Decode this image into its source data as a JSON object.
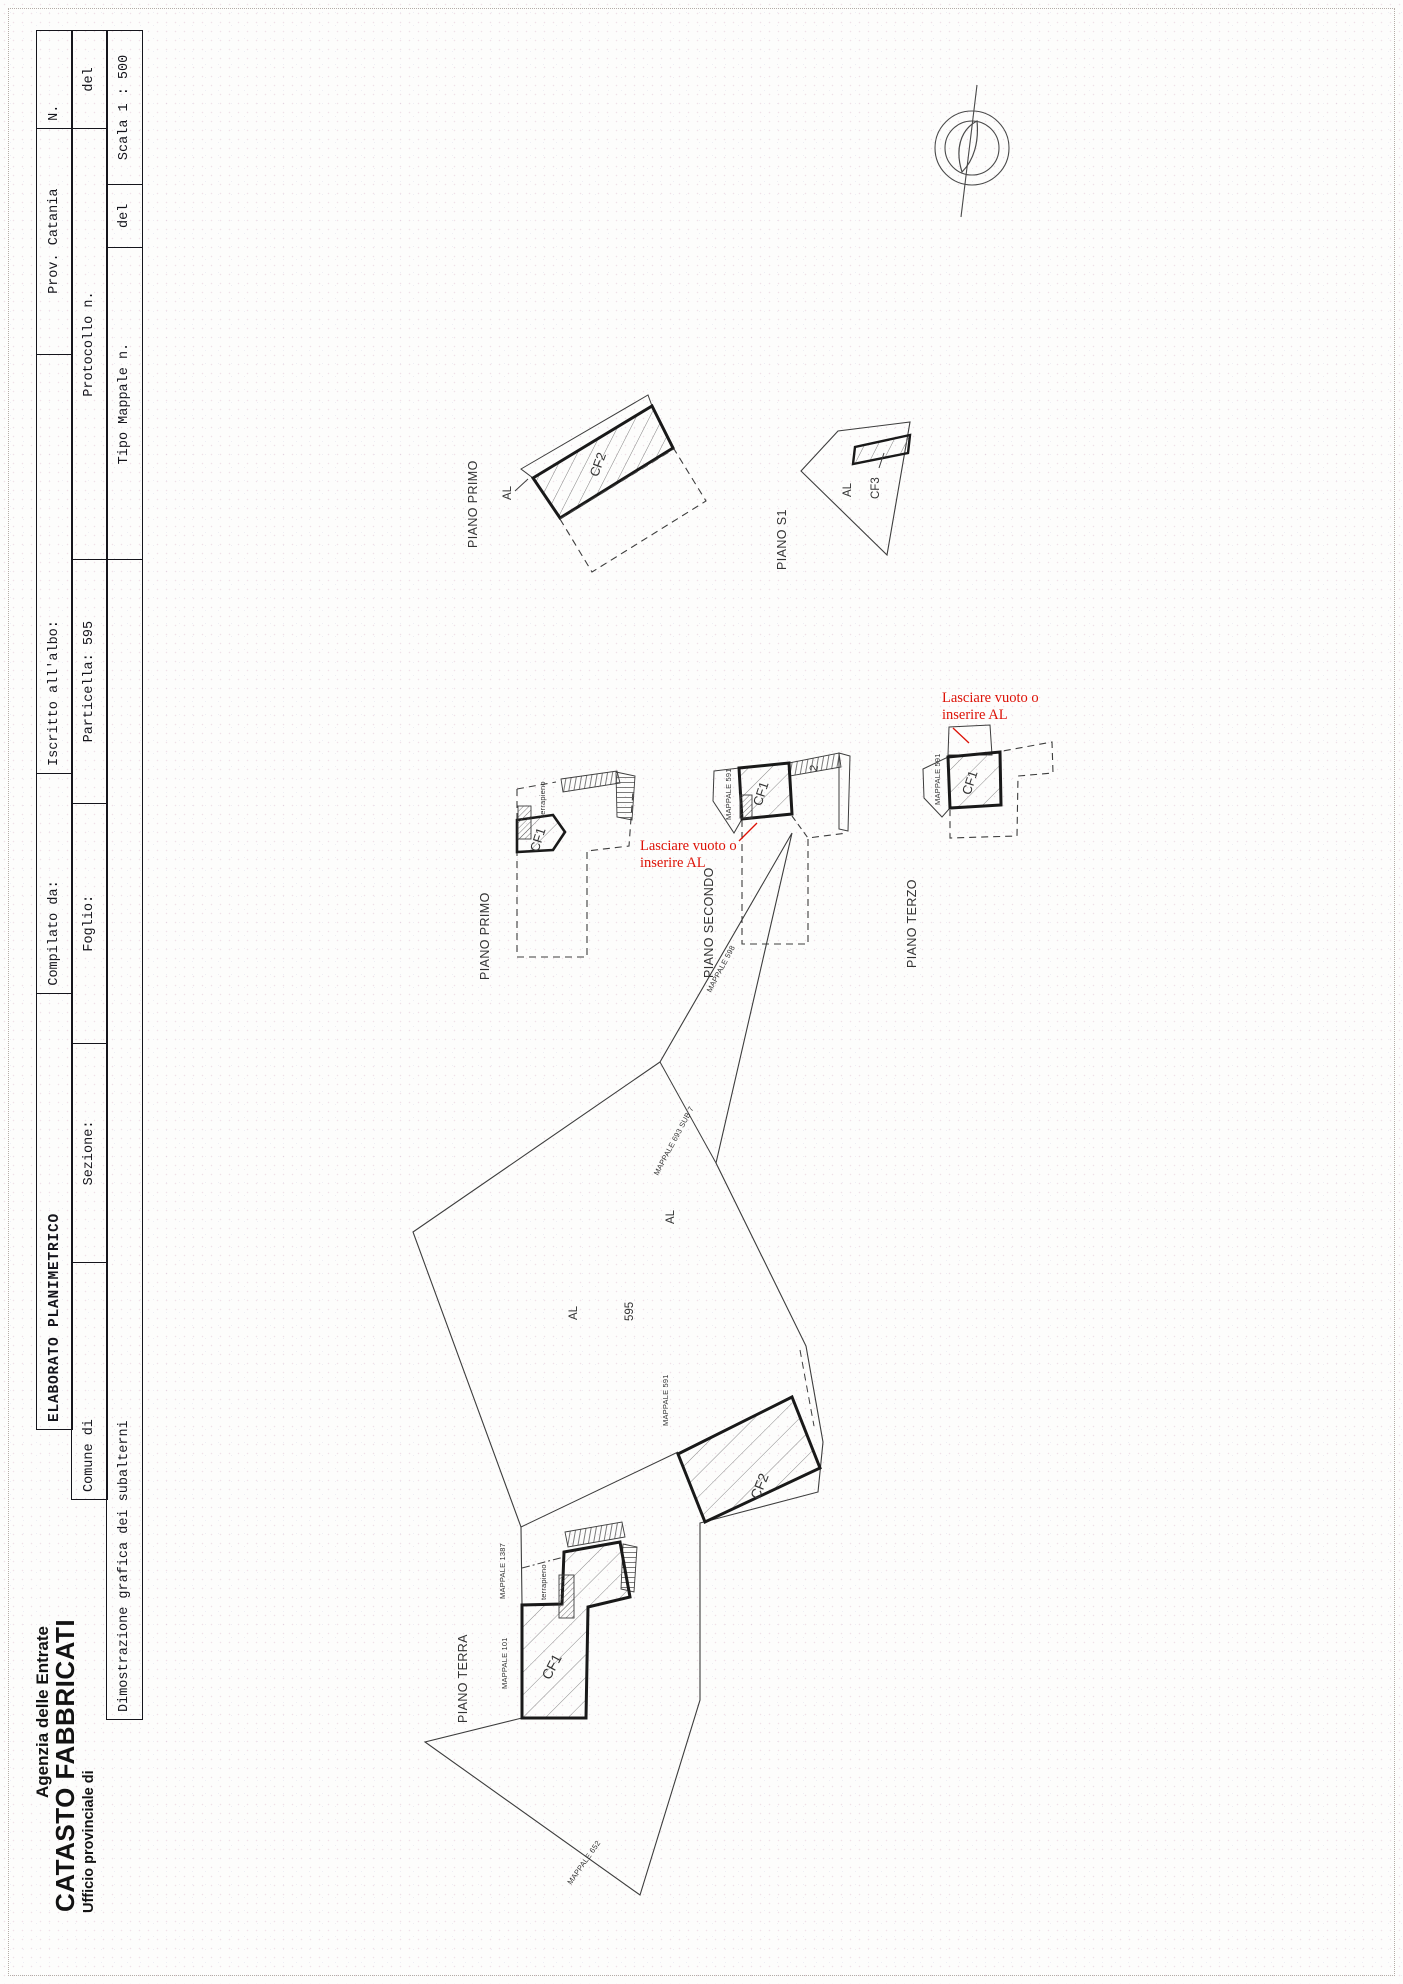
{
  "header": {
    "agency_line1": "Agenzia delle Entrate",
    "agency_line2": "CATASTO FABBRICATI",
    "agency_line3": "Ufficio provinciale di"
  },
  "form": {
    "row1": {
      "elaborato": "ELABORATO PLANIMETRICO",
      "compilato": "Compilato da:",
      "iscritto": "Iscritto all'albo:",
      "prov": "Prov. Catania",
      "n": "N."
    },
    "row2": {
      "comune": "Comune di",
      "sezione": "Sezione:",
      "foglio": "Foglio:",
      "particella": "Particella: 595",
      "protocollo": "Protocollo n.",
      "del": "del"
    },
    "row3": {
      "dimostrazione": "Dimostrazione grafica dei subalterni",
      "tipo": "Tipo Mappale n.",
      "del": "del",
      "scala": "Scala 1 : 500"
    }
  },
  "notes": {
    "red_color": "#dd1207",
    "note1": [
      "Lasciare vuoto o",
      "inserire AL"
    ],
    "note2": [
      "Lasciare vuoto o",
      "inserire AL"
    ]
  },
  "plans": {
    "piano_primo_top": {
      "label": "PIANO PRIMO",
      "cf2": "CF2",
      "al": "AL"
    },
    "piano_s1": {
      "label": "PIANO S1",
      "cf3": "CF3",
      "al": "AL"
    },
    "piano_primo": {
      "label": "PIANO PRIMO",
      "cf1": "CF1",
      "terrapieno": "terrapieno"
    },
    "piano_secondo": {
      "label": "PIANO SECONDO",
      "cf1": "CF1",
      "mappale": "MAPPALE 591",
      "due": "2"
    },
    "piano_terzo": {
      "label": "PIANO TERZO",
      "cf1": "CF1",
      "mappale": "MAPPALE 591"
    },
    "piano_terra": {
      "label": "PIANO TERRA",
      "cf1": "CF1",
      "cf2": "CF2",
      "al_near_cf2": "AL",
      "al_mid": "AL",
      "particella": "595",
      "terrapieno": "terrapieno",
      "mappale_591": "MAPPALE 591",
      "mappale_1387": "MAPPALE 1387",
      "mappale_101": "MAPPALE 101",
      "mappale_652": "MAPPALE 652",
      "mappale_598": "MAPPALE 598",
      "mappale_693": "MAPPALE 693 SUB 7"
    }
  }
}
